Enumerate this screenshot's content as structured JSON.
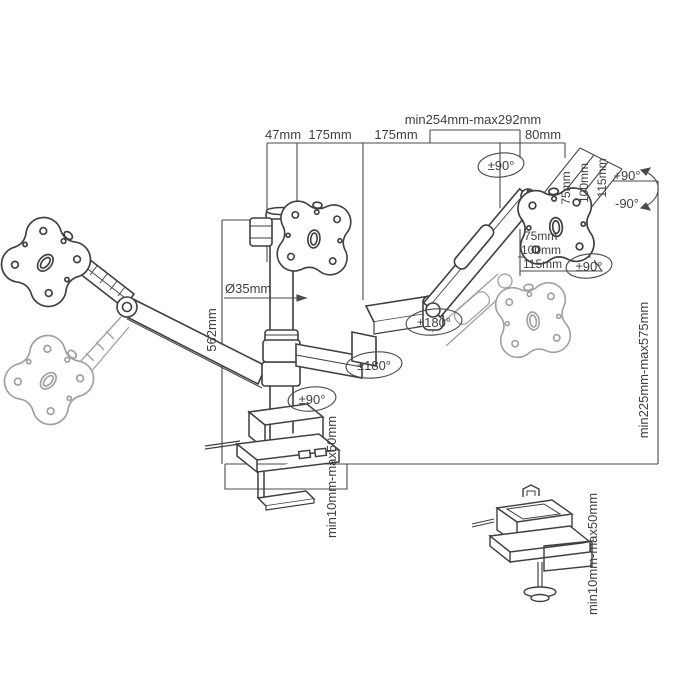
{
  "diagram": {
    "title": "triple-monitor-desk-mount-dimension-drawing",
    "colors": {
      "background": "#ffffff",
      "line": "#3f3f3f",
      "ghost": "#a0a0a0",
      "text": "#3f3f3f"
    },
    "labels": {
      "top_offset": "47mm",
      "top_arm1": "175mm",
      "top_arm2": "175mm",
      "top_range": "min254mm-max292mm",
      "top_end": "80mm",
      "pole_diameter": "Ø35mm",
      "pole_height": "562mm",
      "height_range": "min225mm-max575mm",
      "tilt_up": "+90°",
      "tilt_down": "-90°",
      "vesa_diag_75": "75mm",
      "vesa_diag_100": "100mm",
      "vesa_diag_115": "115mm",
      "vesa_horiz_75": "75mm",
      "vesa_horiz_100": "100mm",
      "vesa_horiz_115": "115mm",
      "head_swivel": "±90°",
      "head_rotate": "±90°",
      "arm_swivel_outer": "±180°",
      "arm_swivel_inner": "±180°",
      "base_swivel": "±90°",
      "clamp_range": "min10mm-max50mm",
      "grommet_range": "min10mm-max50mm"
    }
  }
}
